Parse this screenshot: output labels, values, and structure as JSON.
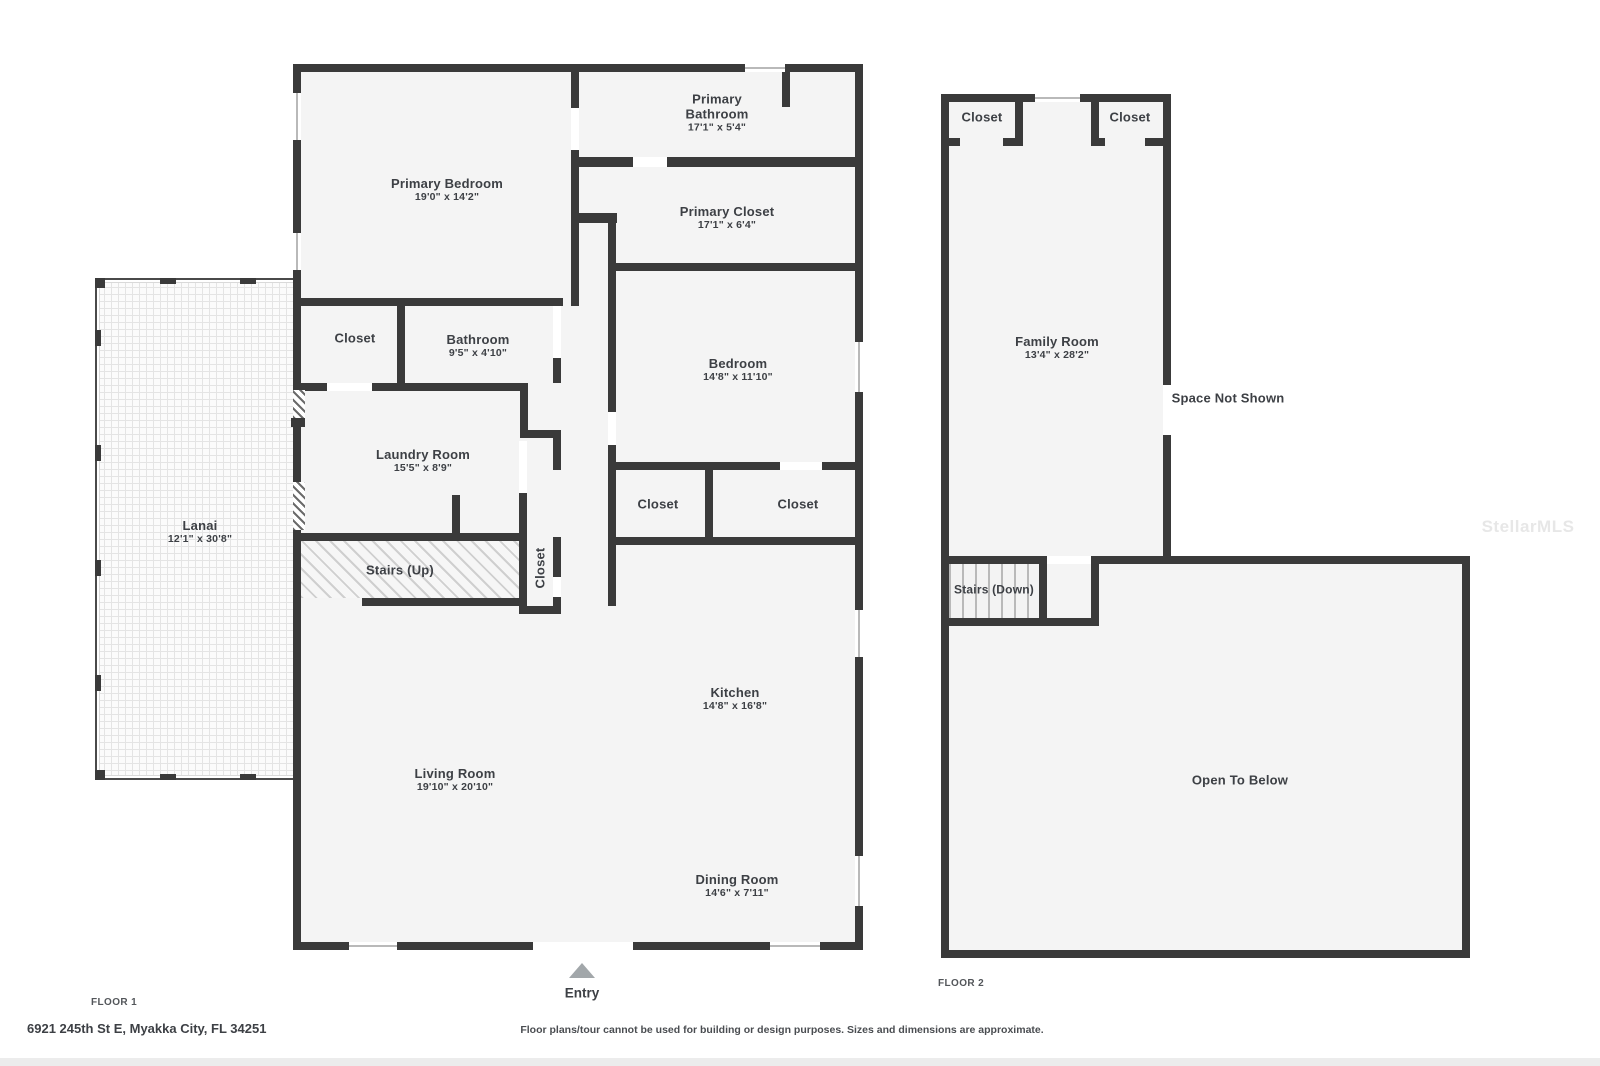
{
  "page": {
    "address": "6921 245th St E, Myakka City, FL 34251",
    "disclaimer": "Floor plans/tour cannot be used for building or design purposes. Sizes and dimensions are approximate.",
    "watermark": "StellarMLS",
    "colors": {
      "wall": "#3a3a3a",
      "room_fill": "#f4f4f4",
      "label_text": "#3d4045",
      "entry_arrow": "#a2a7aa"
    }
  },
  "floor1": {
    "label": "FLOOR 1",
    "entry_label": "Entry",
    "rooms": {
      "primary_bedroom": {
        "name": "Primary Bedroom",
        "dims": "19'0\" x 14'2\""
      },
      "primary_bathroom": {
        "name": "Primary Bathroom",
        "dims": "17'1\" x 5'4\""
      },
      "primary_closet": {
        "name": "Primary Closet",
        "dims": "17'1\" x 6'4\""
      },
      "hall_closet": {
        "name": "Closet"
      },
      "bathroom": {
        "name": "Bathroom",
        "dims": "9'5\" x 4'10\""
      },
      "laundry_room": {
        "name": "Laundry Room",
        "dims": "15'5\" x 8'9\""
      },
      "bedroom": {
        "name": "Bedroom",
        "dims": "14'8\" x 11'10\""
      },
      "bedroom_closet_left": {
        "name": "Closet"
      },
      "bedroom_closet_right": {
        "name": "Closet"
      },
      "hall_closet_small": {
        "name": "Closet"
      },
      "stairs_up": {
        "name": "Stairs (Up)"
      },
      "lanai": {
        "name": "Lanai",
        "dims": "12'1\" x 30'8\""
      },
      "kitchen": {
        "name": "Kitchen",
        "dims": "14'8\" x 16'8\""
      },
      "living_room": {
        "name": "Living Room",
        "dims": "19'10\" x 20'10\""
      },
      "dining_room": {
        "name": "Dining Room",
        "dims": "14'6\" x 7'11\""
      }
    }
  },
  "floor2": {
    "label": "FLOOR 2",
    "rooms": {
      "closet_left": {
        "name": "Closet"
      },
      "closet_right": {
        "name": "Closet"
      },
      "family_room": {
        "name": "Family Room",
        "dims": "13'4\" x 28'2\""
      },
      "space_not_shown": {
        "name": "Space Not Shown"
      },
      "stairs_down": {
        "name": "Stairs (Down)"
      },
      "open_to_below": {
        "name": "Open To Below"
      }
    }
  }
}
